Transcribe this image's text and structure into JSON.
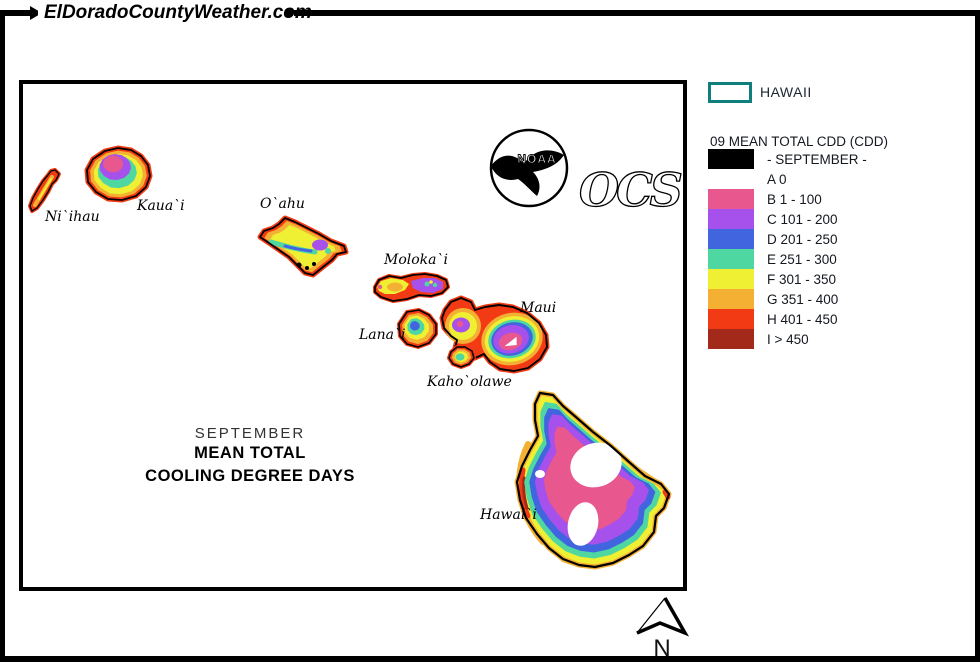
{
  "header": {
    "site_title": "ElDoradoCountyWeather.com"
  },
  "map": {
    "island_labels": [
      "Ni`ihau",
      "Kaua`i",
      "O`ahu",
      "Moloka`i",
      "Lana`i",
      "Maui",
      "Kaho`olawe",
      "Hawai`i"
    ],
    "caption_lines": [
      "SEPTEMBER",
      "MEAN TOTAL",
      "COOLING DEGREE DAYS"
    ],
    "noaa_logo_label": "NOAA",
    "ocs_logo_label": "OCS",
    "north_arrow_label": "N"
  },
  "legend": {
    "region_label": "HAWAII",
    "region_border_color": "#0F7E7C",
    "title": "09 MEAN TOTAL CDD (CDD)",
    "rows": [
      {
        "label": "- SEPTEMBER -",
        "color": "#000000"
      },
      {
        "label": "A 0",
        "color": "#FFFFFF"
      },
      {
        "label": "B 1 - 100",
        "color": "#E8578D"
      },
      {
        "label": "C 101 - 200",
        "color": "#A651EC"
      },
      {
        "label": "D 201 - 250",
        "color": "#4164DF"
      },
      {
        "label": "E 251 - 300",
        "color": "#4FD7A1"
      },
      {
        "label": "F 301 - 350",
        "color": "#EFEF33"
      },
      {
        "label": "G 351 - 400",
        "color": "#F3B033"
      },
      {
        "label": "H 401 - 450",
        "color": "#F23A14"
      },
      {
        "label": "I > 450",
        "color": "#A32A1B"
      }
    ]
  }
}
